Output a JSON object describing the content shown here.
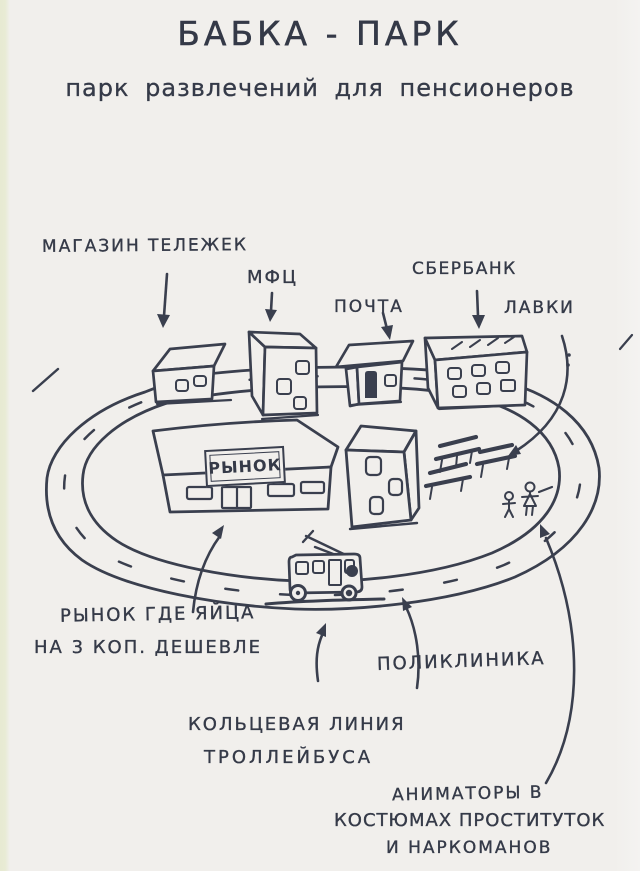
{
  "colors": {
    "ink": "#3a3f4e",
    "paper": "#f1efec",
    "edge_strip": "#e7ead2"
  },
  "title": "БАБКА - ПАРК",
  "subtitle": "парк развлечений для пенсионеров",
  "labels": {
    "cart_shop": "МАГАЗИН ТЕЛЕЖЕК",
    "mfc": "МФЦ",
    "post": "ПОЧТА",
    "sberbank": "СБЕРБАНК",
    "benches": "ЛАВКИ",
    "market_sign": "РЫНОК",
    "eggs_line1": "РЫНОК ГДЕ ЯЙЦА",
    "eggs_line2": "НА 3 КОП. ДЕШЕВЛЕ",
    "polyclinic": "ПОЛИКЛИНИКА",
    "ring_line1": "КОЛЬЦЕВАЯ ЛИНИЯ",
    "ring_line2": "ТРОЛЛЕЙБУСА",
    "animators_line1": "АНИМАТОРЫ В",
    "animators_line2": "КОСТЮМАХ ПРОСТИТУТОК",
    "animators_line3": "И НАРКОМАНОВ"
  }
}
